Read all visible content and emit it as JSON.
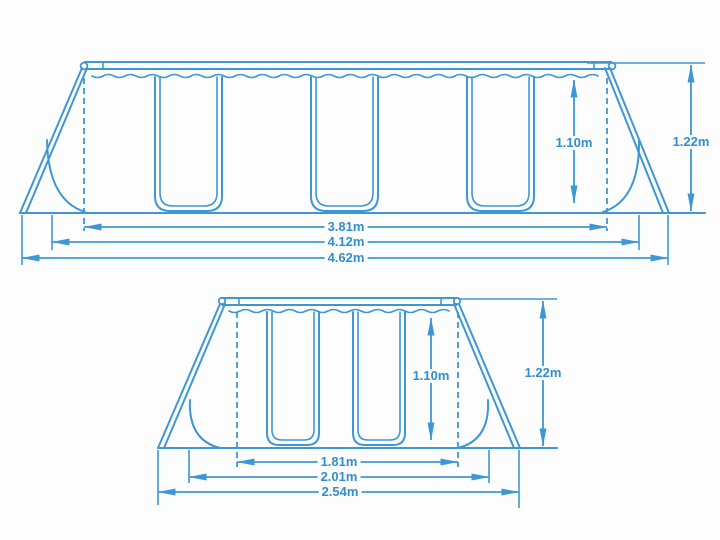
{
  "colors": {
    "line_blue": "#3e97d5",
    "text_blue": "#2f8fd0",
    "background": "#fdfdfd"
  },
  "top_diagram": {
    "height_inner": "1.10m",
    "height_outer": "1.22m",
    "lengths": [
      "3.81m",
      "4.12m",
      "4.62m"
    ]
  },
  "bottom_diagram": {
    "height_inner": "1.10m",
    "height_outer": "1.22m",
    "widths": [
      "1.81m",
      "2.01m",
      "2.54m"
    ]
  }
}
